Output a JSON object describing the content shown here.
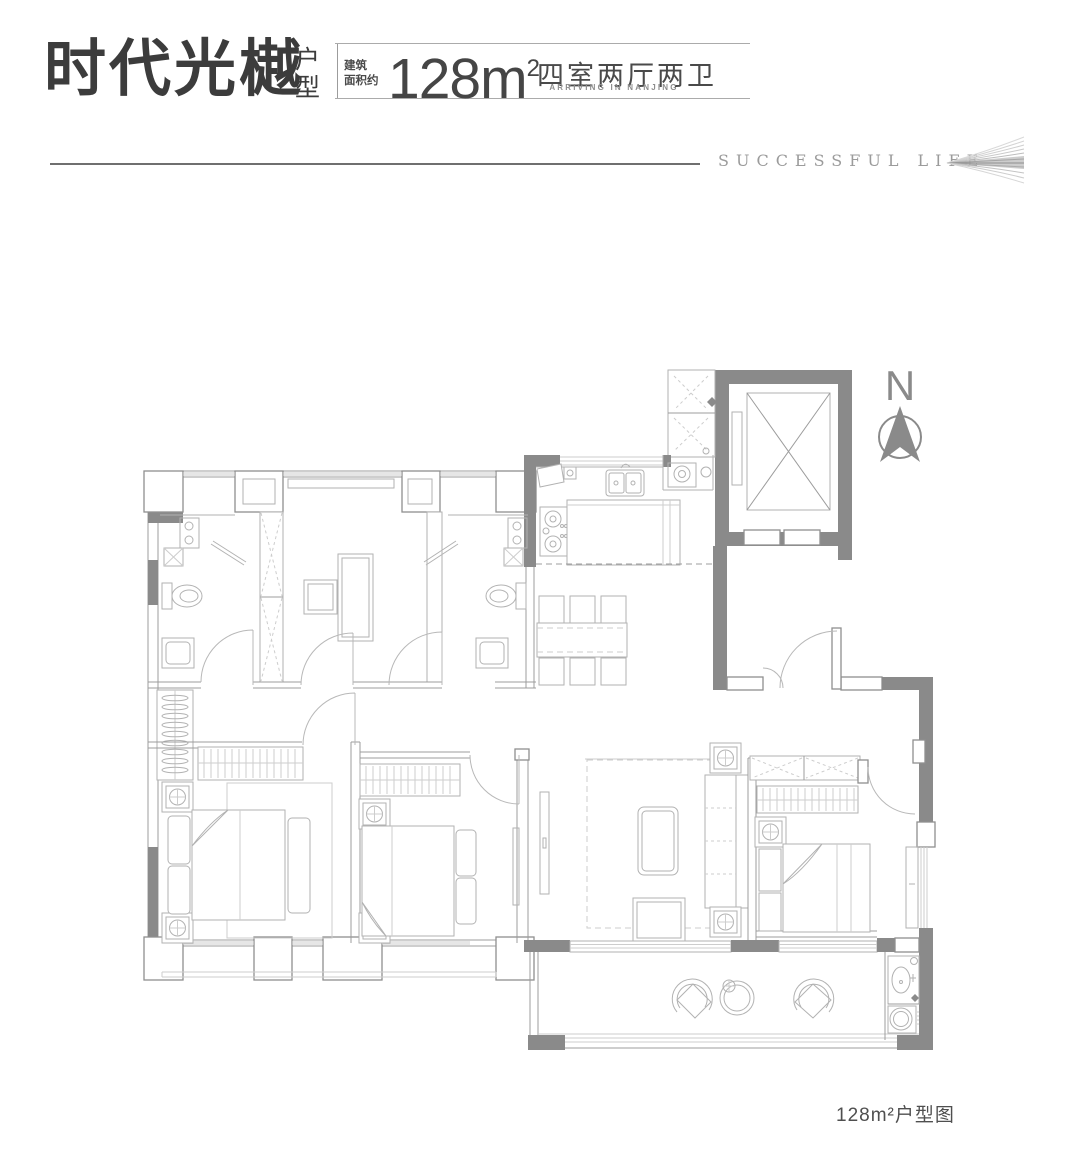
{
  "header": {
    "title": "时代光樾",
    "title_suffix": "户型",
    "area_label_line1": "建筑",
    "area_label_line2": "面积约",
    "area_value": "128m",
    "area_sup": "2",
    "layout_spec": "四室两厅两卫",
    "subtitle_en": "ARRIVING IN NANJING",
    "tagline": "SUCCESSFUL LIFE"
  },
  "compass": {
    "label": "N"
  },
  "caption": {
    "text": "128m²户型图"
  },
  "colors": {
    "ink": "#3c3c3c",
    "text_gray": "#8d8d8d",
    "wall_gray": "#8a8a8a",
    "line_gray": "#9c9c9c",
    "furniture_gray": "#b2b2b2"
  },
  "floor_plan": {
    "description": "apartment floor plan, four bedrooms two living rooms two bathrooms",
    "area_note": "128 square meters"
  }
}
